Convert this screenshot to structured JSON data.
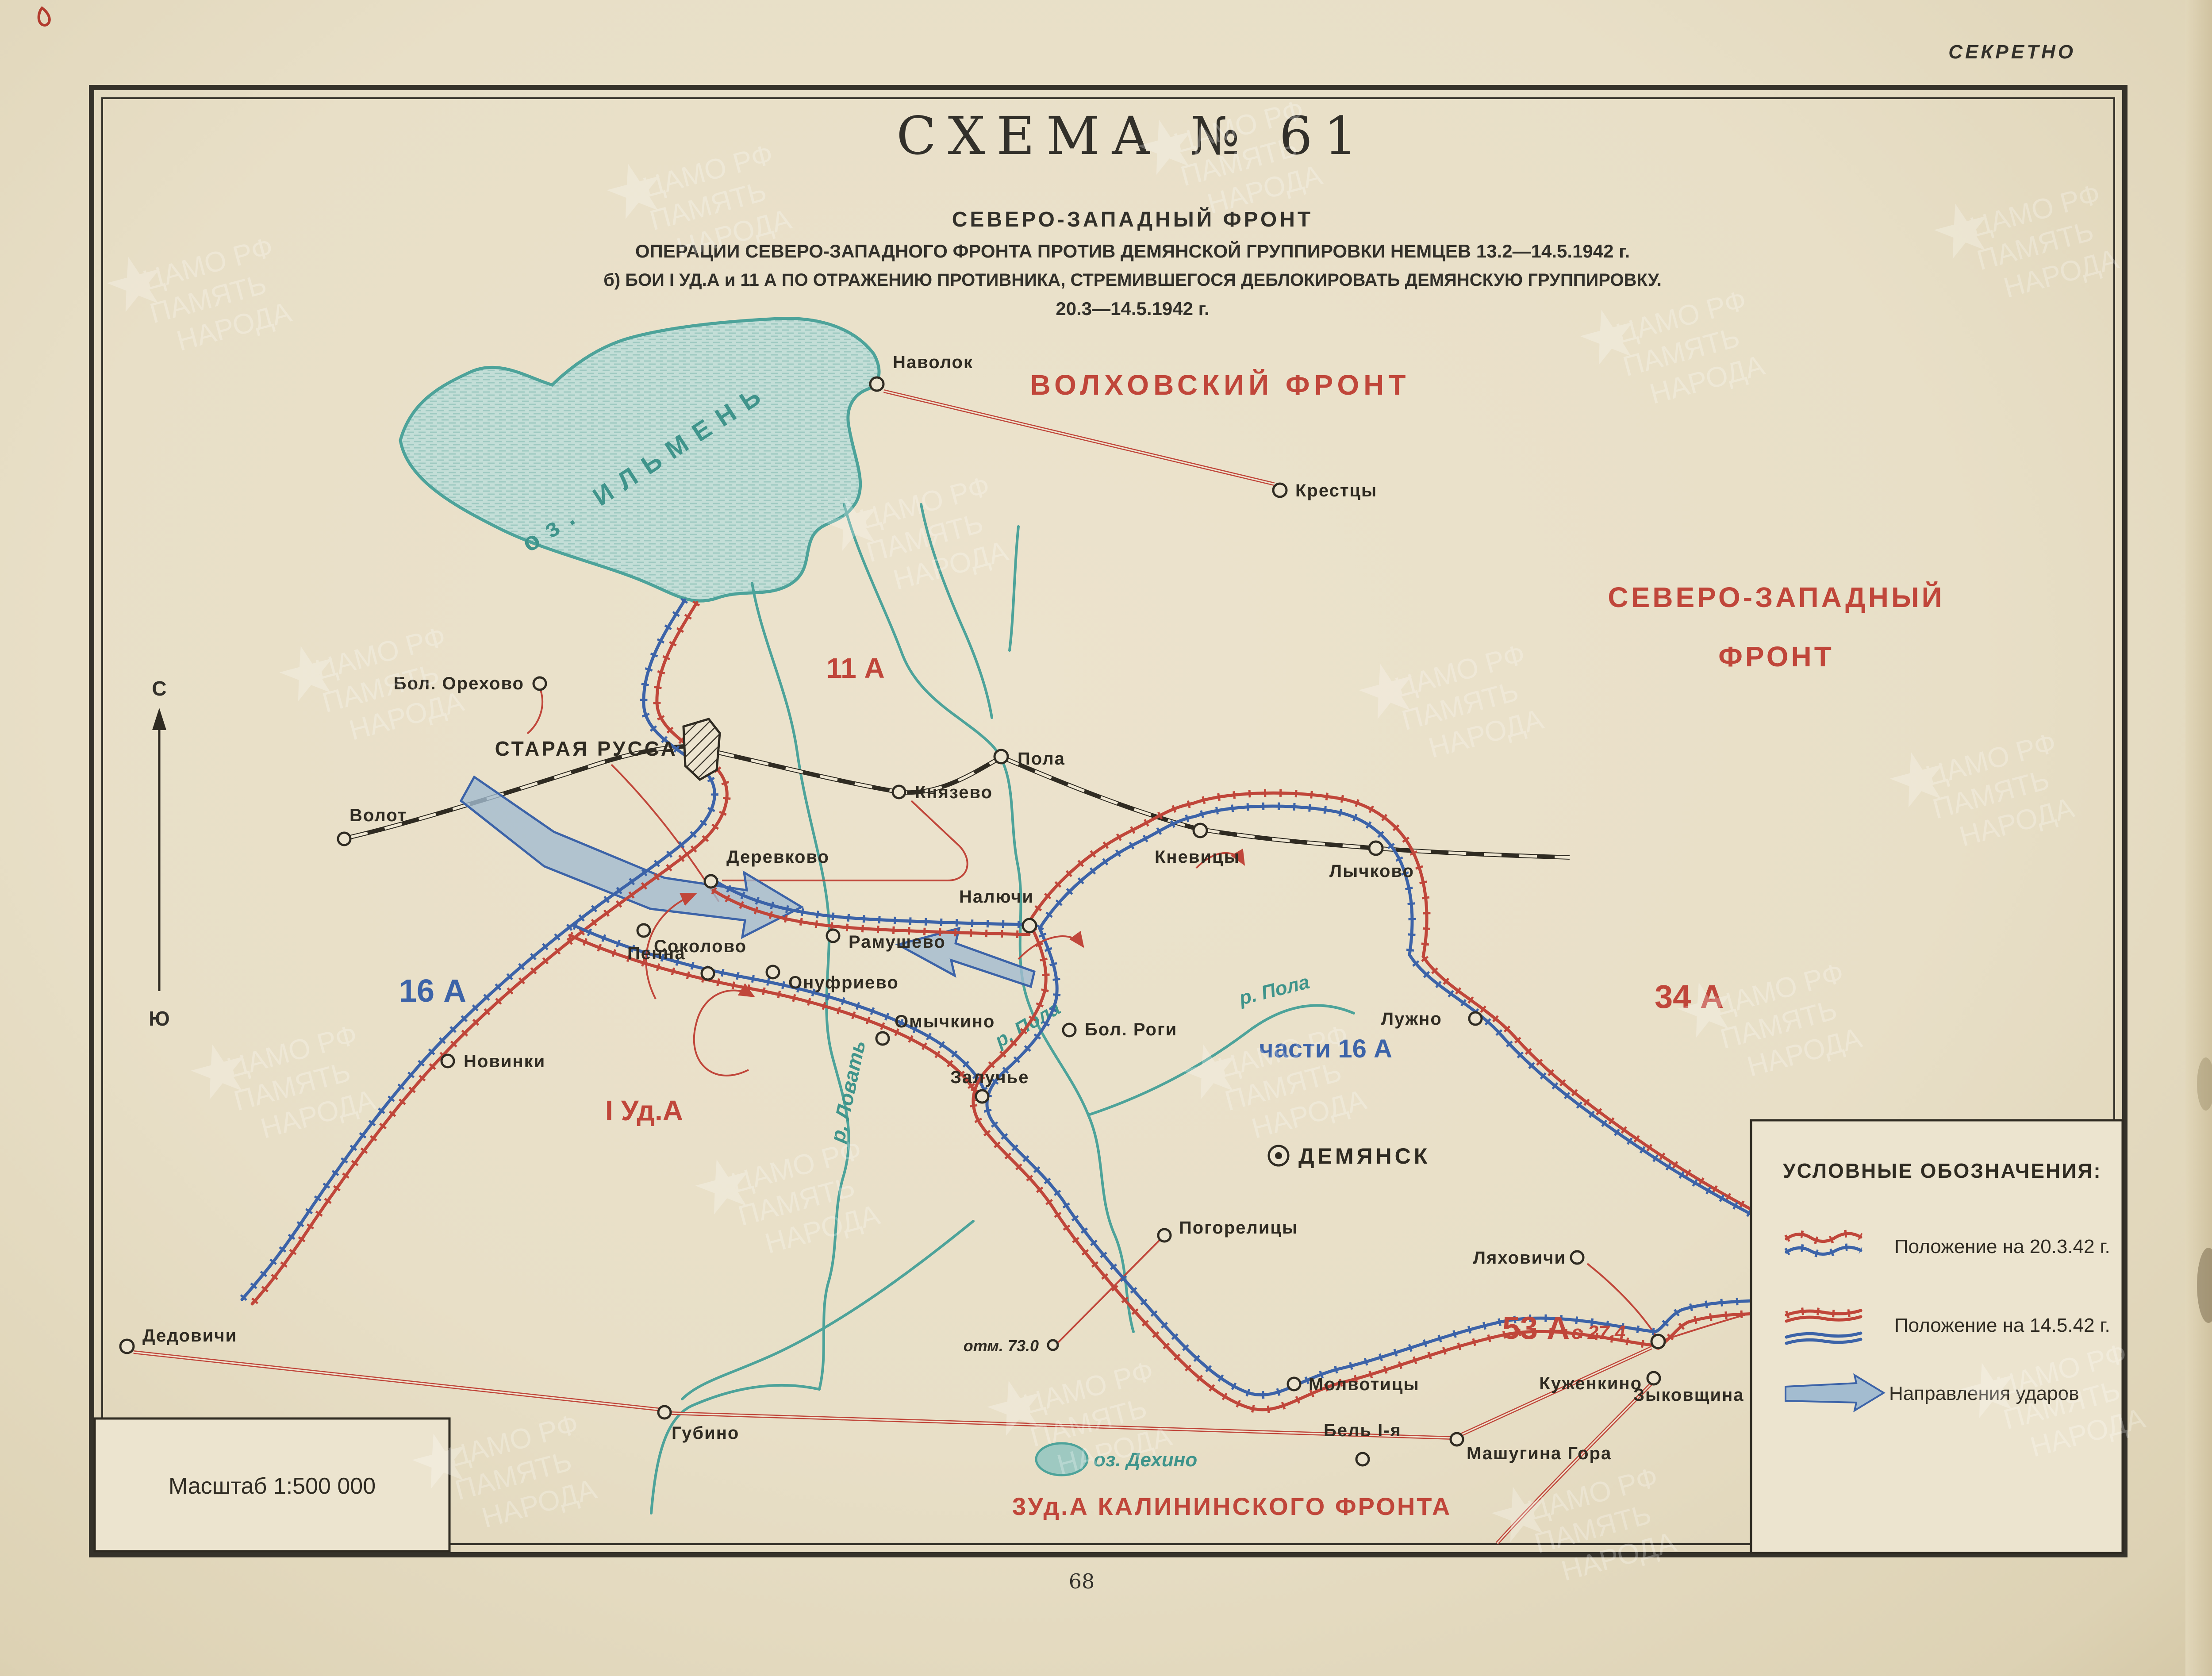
{
  "page": {
    "secret": "СЕКРЕТНО",
    "page_number": "68"
  },
  "title": {
    "scheme": "СХЕМА  № 61",
    "front": "СЕВЕРО-ЗАПАДНЫЙ ФРОНТ",
    "line1": "ОПЕРАЦИИ СЕВЕРО-ЗАПАДНОГО ФРОНТА ПРОТИВ ДЕМЯНСКОЙ ГРУППИРОВКИ НЕМЦЕВ 13.2—14.5.1942 г.",
    "line2": "б) БОИ I УД.А и 11 А ПО ОТРАЖЕНИЮ ПРОТИВНИКА, СТРЕМИВШЕГОСЯ ДЕБЛОКИРОВАТЬ ДЕМЯНСКУЮ ГРУППИРОВКУ.",
    "line3": "20.3—14.5.1942 г."
  },
  "scale": {
    "label": "Масштаб 1:500 000"
  },
  "compass": {
    "north": "С",
    "south": "Ю"
  },
  "legend": {
    "title": "УСЛОВНЫЕ ОБОЗНАЧЕНИЯ:",
    "items": [
      {
        "label": "Положение на 20.3.42 г."
      },
      {
        "label": "Положение на 14.5.42 г."
      },
      {
        "label": "Направления ударов"
      }
    ]
  },
  "fronts": [
    {
      "label": "ВОЛХОВСКИЙ ФРОНТ"
    },
    {
      "label": "СЕВЕРО-ЗАПАДНЫЙ"
    },
    {
      "label": "ФРОНТ"
    },
    {
      "label": "3Уд.А КАЛИНИНСКОГО ФРОНТА"
    }
  ],
  "armies": [
    {
      "label": "11 А"
    },
    {
      "label": "16 А"
    },
    {
      "label": "34 А"
    },
    {
      "label": "части 16 А"
    },
    {
      "label": "I Уд.А"
    },
    {
      "label": "53 А"
    },
    {
      "label": "с 27.4"
    }
  ],
  "water": [
    {
      "label": "оз. ИЛЬМЕНЬ"
    },
    {
      "label": "р. Ловать"
    },
    {
      "label": "р. Пола"
    },
    {
      "label": "р. Пола"
    },
    {
      "label": "оз. Дехино"
    }
  ],
  "towns": [
    {
      "name": "Наволок"
    },
    {
      "name": "Крестцы"
    },
    {
      "name": "Бол. Орехово"
    },
    {
      "name": "Волот"
    },
    {
      "name": "Деревково"
    },
    {
      "name": "Князево"
    },
    {
      "name": "Пола"
    },
    {
      "name": "Кневицы"
    },
    {
      "name": "Лычково"
    },
    {
      "name": "Пенна"
    },
    {
      "name": "Налючи"
    },
    {
      "name": "Рамушево"
    },
    {
      "name": "Соколово"
    },
    {
      "name": "Онуфриево"
    },
    {
      "name": "Омычкино"
    },
    {
      "name": "Бол. Роги"
    },
    {
      "name": "Залучье"
    },
    {
      "name": "Лужно"
    },
    {
      "name": "ДЕМЯНСК"
    },
    {
      "name": "Погорелицы"
    },
    {
      "name": "отм. 73.0"
    },
    {
      "name": "Бель I-я"
    },
    {
      "name": "Ляховичи"
    },
    {
      "name": "Зыковщина"
    },
    {
      "name": "Молвотицы"
    },
    {
      "name": "Куженкино"
    },
    {
      "name": "Машугина Гора"
    },
    {
      "name": "Губино"
    },
    {
      "name": "Дедовичи"
    },
    {
      "name": "Новинки"
    },
    {
      "name": "СТАРАЯ РУССА"
    }
  ],
  "watermark": {
    "l1": "ЦАМО РФ",
    "l2": "ПАМЯТЬ",
    "l3": "НАРОДА"
  },
  "colors": {
    "soviet_red": "#c0463a",
    "german_blue": "#3c63a8",
    "water_teal": "#4da39a",
    "ink": "#2f2b22",
    "paper": "#ece4cf"
  }
}
